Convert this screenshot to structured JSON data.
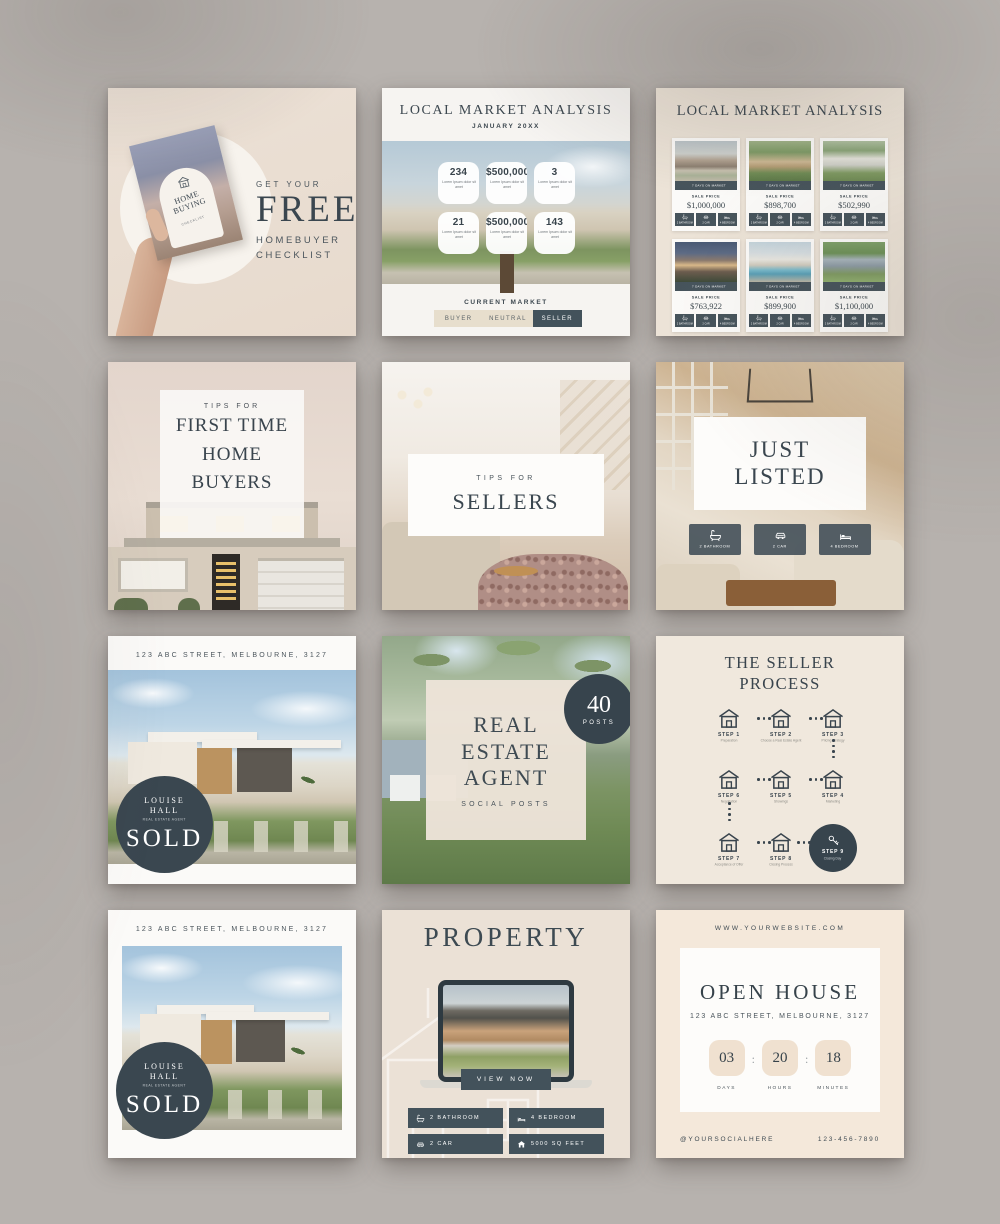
{
  "colors": {
    "slate": "#43525b",
    "slate_dark": "#37444d",
    "cream": "#ece3d7",
    "beige_toggle": "#e7decd",
    "page_bg": "#b7b2ae"
  },
  "icons": {
    "calendar": "▦",
    "bath": "bathtub",
    "car": "car",
    "bed": "bed",
    "house": "house",
    "house_outline": "house-outline",
    "key": "key",
    "home_logo": "house-badge"
  },
  "p1": {
    "eyebrow": "GET YOUR",
    "headline": "FREE",
    "sub1": "HOMEBUYER",
    "sub2": "CHECKLIST",
    "card_line1": "HOME",
    "card_line2": "BUYING",
    "card_line3": "CHECKLIST"
  },
  "p2": {
    "title": "LOCAL MARKET ANALYSIS",
    "subtitle": "JANUARY 20XX",
    "stats": [
      {
        "value": "234",
        "caption": "Lorem Ipsum dolor sit amet"
      },
      {
        "value": "$500,000",
        "caption": "Lorem Ipsum dolor sit amet"
      },
      {
        "value": "3",
        "caption": "Lorem Ipsum dolor sit amet"
      },
      {
        "value": "21",
        "caption": "Lorem Ipsum dolor sit amet"
      },
      {
        "value": "$500,000",
        "caption": "Lorem Ipsum dolor sit amet"
      },
      {
        "value": "143",
        "caption": "Lorem Ipsum dolor sit amet"
      }
    ],
    "market_label": "CURRENT MARKET",
    "toggle": [
      {
        "label": "BUYER"
      },
      {
        "label": "NEUTRAL"
      },
      {
        "label": "SELLER"
      }
    ],
    "active_segment": "SELLER"
  },
  "p3": {
    "title": "LOCAL MARKET ANALYSIS",
    "days_label": "7 DAYS ON MARKET",
    "price_label": "SALE PRICE",
    "cards": [
      {
        "price": "$1,000,000"
      },
      {
        "price": "$898,700"
      },
      {
        "price": "$502,990"
      },
      {
        "price": "$763,922"
      },
      {
        "price": "$899,900"
      },
      {
        "price": "$1,100,000"
      }
    ],
    "features": [
      {
        "label": "2 BATHROOM"
      },
      {
        "label": "2 CAR"
      },
      {
        "label": "4 BEDROOM"
      }
    ]
  },
  "p4": {
    "eyebrow": "TIPS FOR",
    "line1": "FIRST TIME",
    "line2": "HOME",
    "line3": "BUYERS"
  },
  "p5": {
    "eyebrow": "TIPS FOR",
    "title": "SELLERS"
  },
  "p6": {
    "line1": "JUST",
    "line2": "LISTED",
    "badges": [
      {
        "label": "2 BATHROOM"
      },
      {
        "label": "2 CAR"
      },
      {
        "label": "4 BEDROOM"
      }
    ]
  },
  "p7": {
    "address": "123 ABC STREET, MELBOURNE, 3127",
    "agent_line1": "LOUISE",
    "agent_line2": "HALL",
    "agent_role": "REAL ESTATE AGENT",
    "status": "SOLD"
  },
  "p8": {
    "line1": "REAL",
    "line2": "ESTATE",
    "line3": "AGENT",
    "sub": "SOCIAL POSTS",
    "badge_value": "40",
    "badge_label": "POSTS"
  },
  "p9": {
    "title1": "THE SELLER",
    "title2": "PROCESS",
    "steps": [
      {
        "step": "STEP 1",
        "label": "Preparation"
      },
      {
        "step": "STEP 2",
        "label": "Choose a Real Estate Agent"
      },
      {
        "step": "STEP 3",
        "label": "Pricing Strategy"
      },
      {
        "step": "STEP 6",
        "label": "Negotiation"
      },
      {
        "step": "STEP 5",
        "label": "Showings"
      },
      {
        "step": "STEP 4",
        "label": "Marketing"
      },
      {
        "step": "STEP 7",
        "label": "Acceptance of Offer"
      },
      {
        "step": "STEP 8",
        "label": "Closing Process"
      },
      {
        "step": "STEP 9",
        "label": "Closing Day"
      }
    ]
  },
  "p10": {
    "address": "123 ABC STREET, MELBOURNE, 3127",
    "agent_line1": "LOUISE",
    "agent_line2": "HALL",
    "agent_role": "REAL ESTATE AGENT",
    "status": "SOLD"
  },
  "p11": {
    "title": "PROPERTY",
    "cta": "VIEW NOW",
    "badges": [
      {
        "label": "2 BATHROOM"
      },
      {
        "label": "4 BEDROOM"
      },
      {
        "label": "2 CAR"
      },
      {
        "label": "5000 SQ FEET"
      }
    ]
  },
  "p12": {
    "website": "WWW.YOURWEBSITE.COM",
    "title": "OPEN HOUSE",
    "address": "123 ABC STREET, MELBOURNE, 3127",
    "countdown": [
      {
        "value": "03",
        "label": "DAYS"
      },
      {
        "value": "20",
        "label": "HOURS"
      },
      {
        "value": "18",
        "label": "MINUTES"
      }
    ],
    "colon": ":",
    "social": "@YOURSOCIALHERE",
    "phone": "123-456-7890"
  }
}
